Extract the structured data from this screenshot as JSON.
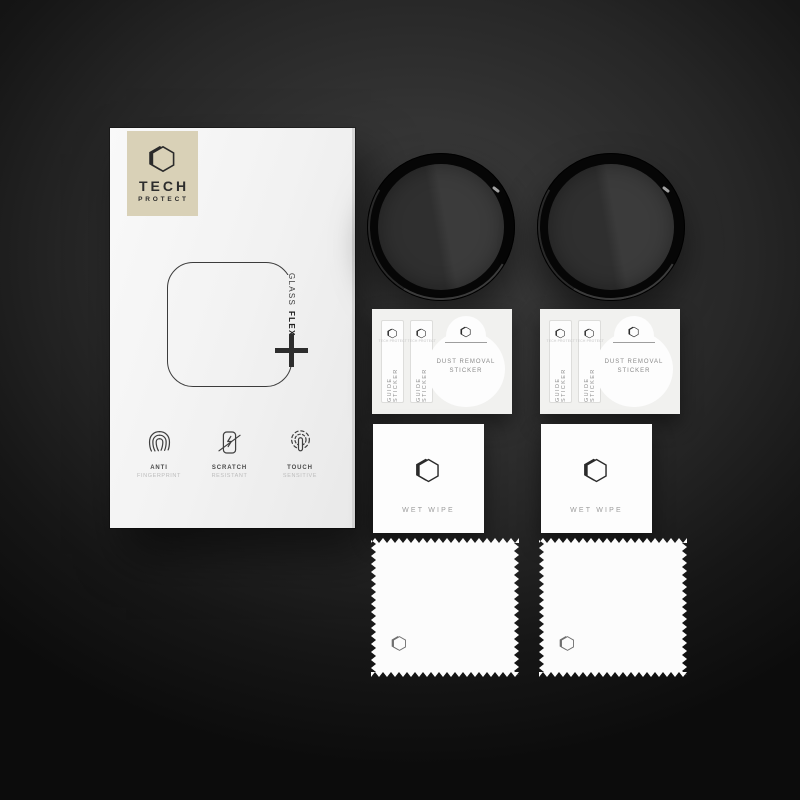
{
  "product": {
    "brand": {
      "name_line1": "TECH",
      "name_line2": "PROTECT"
    },
    "series": {
      "word1": "GLASS",
      "word2": "FLEX"
    },
    "features": [
      {
        "title": "ANTI",
        "subtitle": "FINGERPRINT"
      },
      {
        "title": "SCRATCH",
        "subtitle": "RESISTANT"
      },
      {
        "title": "TOUCH",
        "subtitle": "SENSITIVE"
      }
    ]
  },
  "accessories": {
    "guide_sticker_label": "GUIDE STICKER",
    "strip_micro_text": "TECH PROTECT",
    "dust_removal_line1": "DUST REMOVAL",
    "dust_removal_line2": "STICKER",
    "wet_wipe_label": "WET WIPE"
  },
  "colors": {
    "background_center": "#3e3e3e",
    "background_edge": "#0c0c0c",
    "box_surface": "#f2f2f2",
    "brand_plate_beige": "#d9d1b7",
    "ink": "#2b2b2b",
    "protector_ring_black": "#060606",
    "protector_glass_gray": "#383838",
    "paper_white": "#fdfdfd",
    "label_gray": "#8d8d8d"
  }
}
